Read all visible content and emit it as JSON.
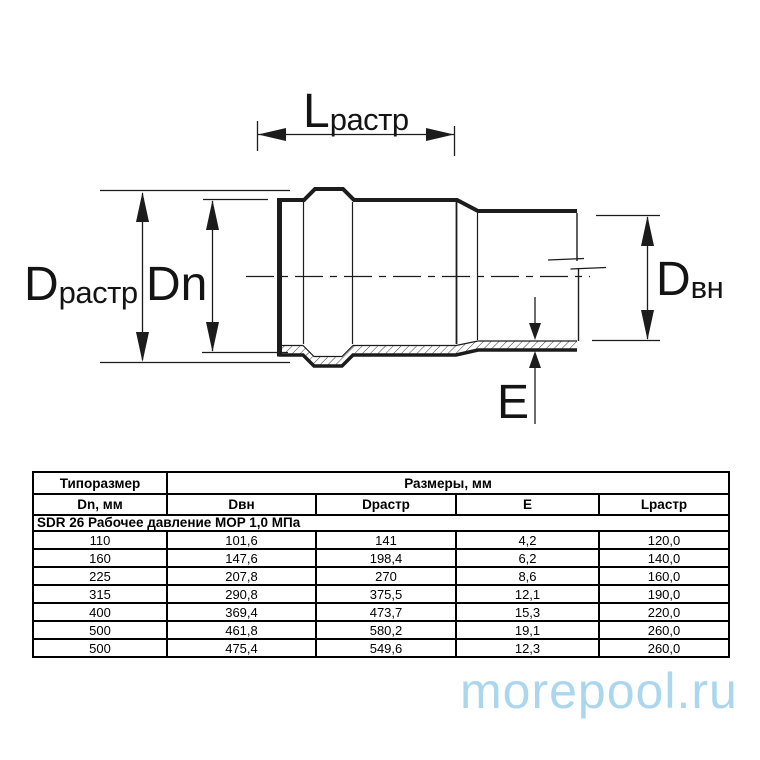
{
  "diagram": {
    "labels": {
      "l_rastr": {
        "main": "L",
        "sub": "растр"
      },
      "d_rastr": {
        "main": "D",
        "sub": "растр"
      },
      "dn": {
        "main": "Dn"
      },
      "d_vn": {
        "main": "D",
        "sub": "вн"
      },
      "e": {
        "main": "E"
      }
    },
    "colors": {
      "line": "#1c1c1c",
      "background": "#ffffff"
    }
  },
  "table": {
    "header": {
      "col_size": "Типоразмер",
      "col_dims": "Размеры, мм",
      "sub": [
        "Dn, мм",
        "Dвн",
        "Dрастр",
        "E",
        "Lрастр"
      ]
    },
    "section": "SDR 26 Рабочее давление MOP 1,0 МПа",
    "rows": [
      [
        "110",
        "101,6",
        "141",
        "4,2",
        "120,0"
      ],
      [
        "160",
        "147,6",
        "198,4",
        "6,2",
        "140,0"
      ],
      [
        "225",
        "207,8",
        "270",
        "8,6",
        "160,0"
      ],
      [
        "315",
        "290,8",
        "375,5",
        "12,1",
        "190,0"
      ],
      [
        "400",
        "369,4",
        "473,7",
        "15,3",
        "220,0"
      ],
      [
        "500",
        "461,8",
        "580,2",
        "19,1",
        "260,0"
      ],
      [
        "500",
        "475,4",
        "549,6",
        "12,3",
        "260,0"
      ]
    ]
  },
  "watermark": {
    "text": "morepool.ru",
    "color": "#aad7ee"
  }
}
